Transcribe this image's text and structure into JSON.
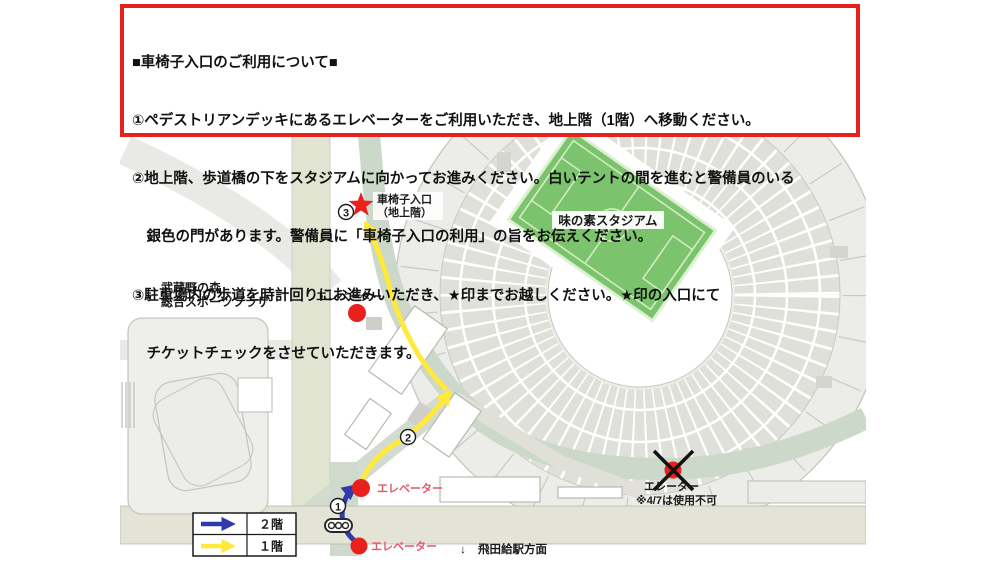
{
  "notice": {
    "title": "■車椅子入口のご利用について■",
    "lines": [
      "①ペデストリアンデッキにあるエレベーターをご利用いただき、地上階（1階）へ移動ください。",
      "②地上階、歩道橋の下をスタジアムに向かってお進みください。白いテントの間を進むと警備員のいる",
      "　銀色の門があります。警備員に「車椅子入口の利用」の旨をお伝えください。",
      "③駐車場内の歩道を時計回りにお進みいただき、★印までお越しください。★印の入口にて",
      "　チケットチェックをさせていただきます。"
    ]
  },
  "map": {
    "stadium_label": "味の素スタジアム",
    "plaza_label_line1": "武蔵野の森",
    "plaza_label_line2": "総合スポーツプラザ",
    "entrance_label_line1": "車椅子入口",
    "entrance_label_line2": "（地上階）",
    "elevator_mid": "エレベーター",
    "elevator_bridge": "エレベーター",
    "elevator_station": "エレベーター",
    "elevator_closed": "エレーター",
    "elevator_closed_note": "※4/7は使用不可",
    "station_arrow": "↓",
    "station_direction": "飛田給駅方面",
    "step1": "1",
    "step2": "2",
    "step3": "3"
  },
  "legend": {
    "floor2": "２階",
    "floor1": "１階"
  },
  "colors": {
    "notice_border_red": "#e5221e",
    "route_2f_blue": "#2f3aad",
    "route_1f_yellow": "#ffe93b",
    "marker_red": "#e8211d",
    "elevator_text_red": "#e85468",
    "pitch_green": "#7cc36d",
    "walkway_green": "#ccd8c9"
  }
}
